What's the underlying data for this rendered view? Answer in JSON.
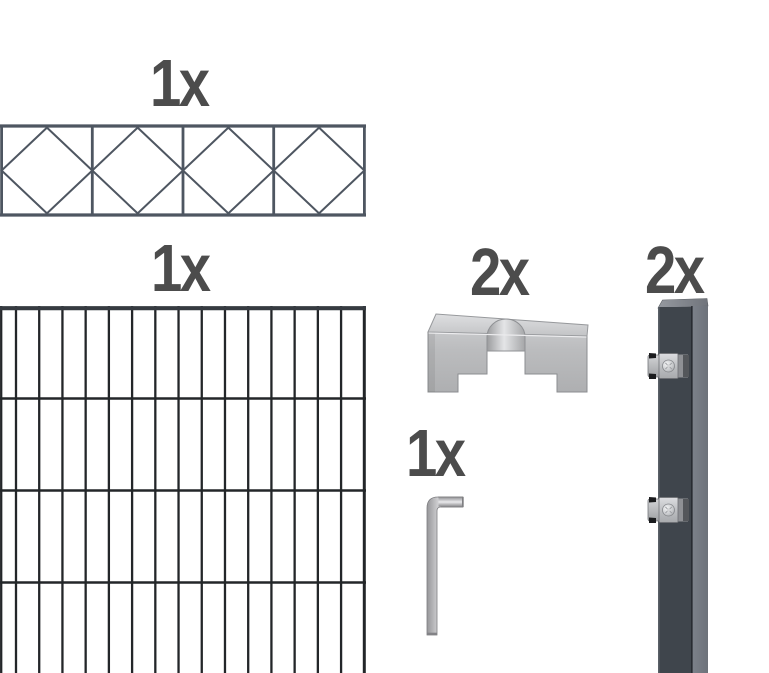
{
  "figure": {
    "title": "fence-kit-contents",
    "background": "#ffffff"
  },
  "items": {
    "decorative_panel": {
      "qty": "1x",
      "name": "ornamental-grid-fence-panel"
    },
    "mesh_panel": {
      "qty": "1x",
      "name": "double-rod-mesh-fence-panel"
    },
    "cover_brackets": {
      "qty": "2x",
      "name": "post-cover-bracket"
    },
    "hex_key": {
      "qty": "1x",
      "name": "hex-key"
    },
    "posts": {
      "qty": "2x",
      "name": "anthracite-post-with-clamps"
    }
  },
  "colors": {
    "label_text": "#4c4c4c",
    "decor_wire": "#4e5661",
    "mesh_wire": "#232629",
    "mesh_rail": "#363b41",
    "post_front": "#3f454c",
    "post_front_highlight": "#5a6067",
    "post_side_dark_edge": "#23272c",
    "clamp_nub": "#1b1c1e"
  },
  "graphics": {
    "decorative_panel": {
      "width": 366,
      "height": 93,
      "cells": 4,
      "rail_stroke": 3.2,
      "divider_stroke": 2.8,
      "diamond_stroke": 2
    },
    "mesh_panel": {
      "width": 366,
      "height": 368,
      "columns": 16,
      "first_bar_x": 16,
      "bar_spacing": 23.22,
      "bar_stroke": 2.3,
      "edge_bar_x": 1.2,
      "last_bar_stroke": 3,
      "rows": [
        93.5,
        185.5,
        277.5
      ],
      "row_stroke": 2.6,
      "top_rail_y": 3.2,
      "top_rail_stroke": 4.2
    }
  }
}
